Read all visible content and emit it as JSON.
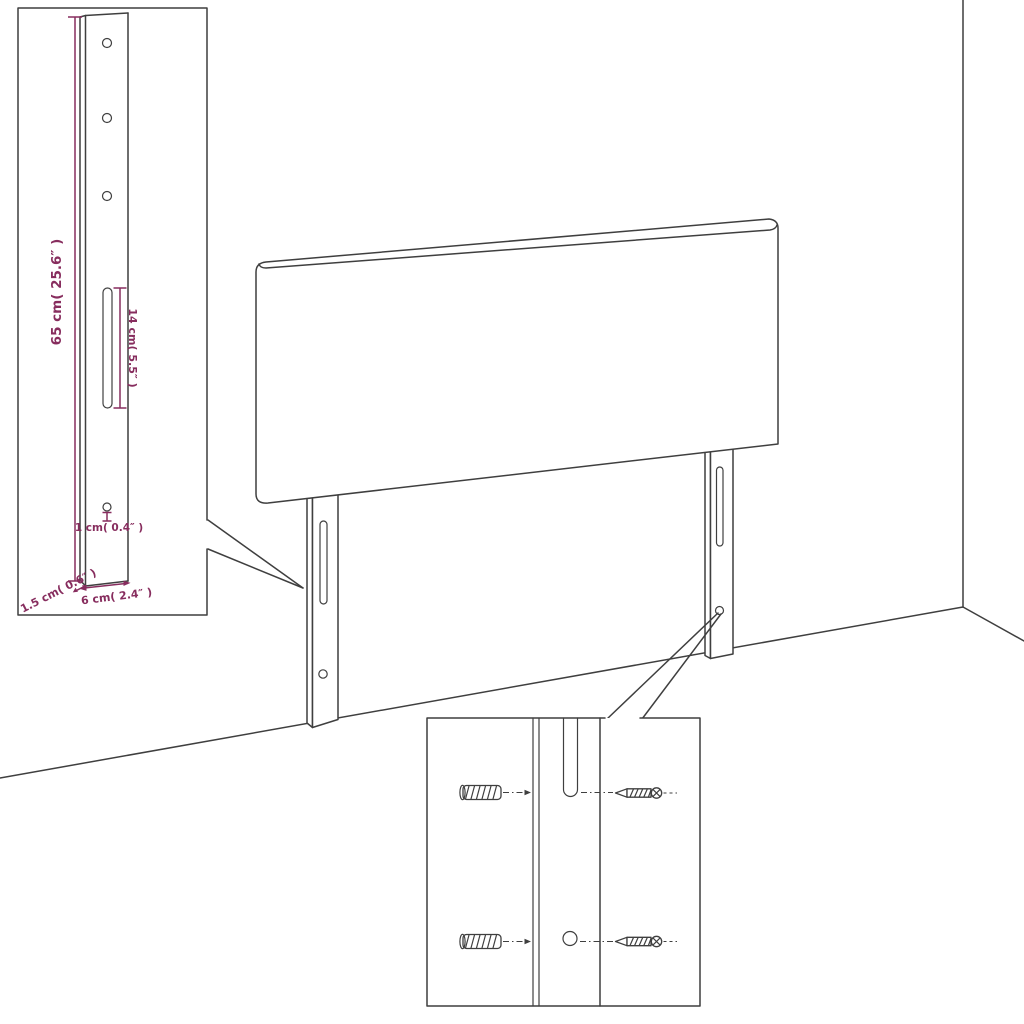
{
  "diagram": {
    "title": "headboard-with-legs assembly dimension diagram",
    "dimensions": {
      "leg_height": "65 cm( 25.6″ )",
      "slot_length": "14 cm( 5.5″ )",
      "hole_size": "1 cm( 0.4″ )",
      "leg_width": "6 cm( 2.4″ )",
      "leg_thickness": "1.5 cm( 0.6″ )"
    },
    "parts": {
      "main": "upholstered headboard panel with two mounting legs",
      "inset_top_left": "leg detail with drill holes, slot and dimensions",
      "inset_bottom": "mounting detail with wall anchors and screws",
      "scene": "room corner with wall and floor lines"
    },
    "colors": {
      "line": "#3f3f3f",
      "dimension": "#872d5e",
      "background": "#ffffff"
    }
  }
}
